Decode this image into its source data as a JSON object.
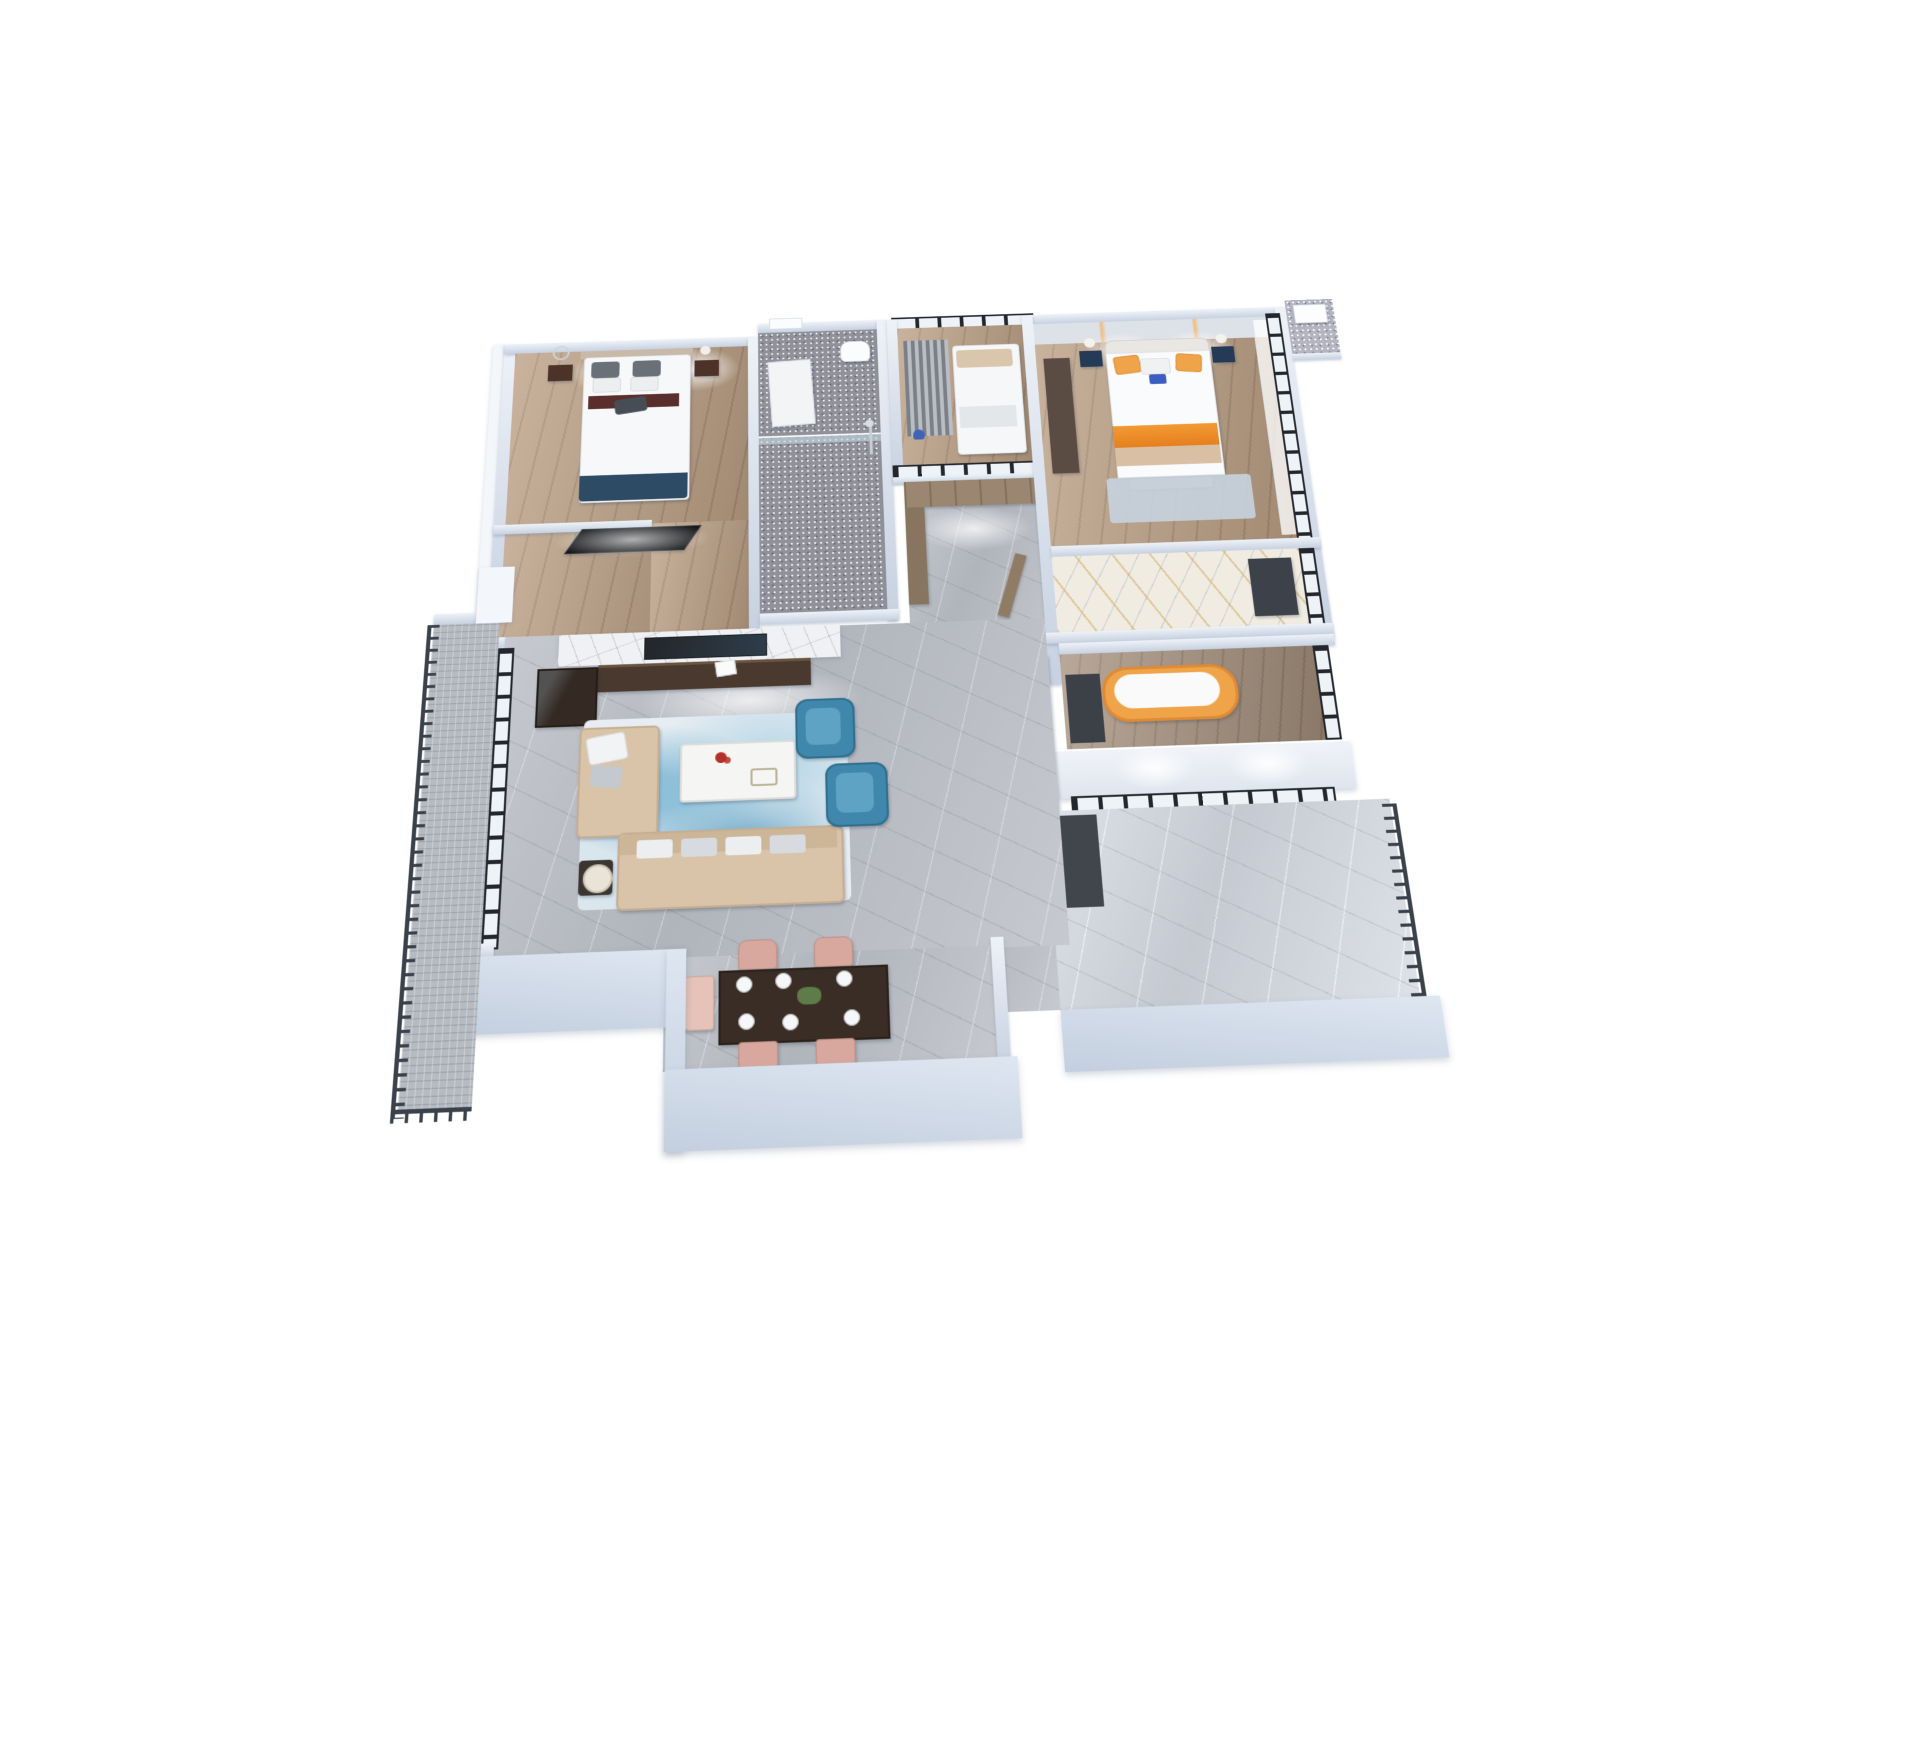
{
  "scene": {
    "type": "3d-floorplan-cutaway-render",
    "view": "overhead dollhouse perspective of a three-bedroom apartment on a white background",
    "rooms": [
      {
        "id": "second-bedroom",
        "area": "top-left",
        "floor": "wood",
        "contents": [
          "double-bed",
          "gray-pillows",
          "dark-red-runner",
          "nightstand-left",
          "nightstand-right",
          "ring-sculpture-lamp",
          "ball-lamp",
          "wall-mounted-tv",
          "ceiling-downlights"
        ]
      },
      {
        "id": "main-bathroom",
        "area": "top-center",
        "floor": "dark-glitter-tile",
        "contents": [
          "toilet",
          "shower-set",
          "glass-partition",
          "white-bath-mat",
          "white-door"
        ]
      },
      {
        "id": "glass-study",
        "area": "center-top",
        "floor": "wood",
        "contents": [
          "daybed-white-bedding",
          "patterned-curtain",
          "blue-figurine",
          "black-framed-glass-walls"
        ]
      },
      {
        "id": "master-bedroom",
        "area": "top-right",
        "floor": "wood",
        "contents": [
          "bed-white-duvet",
          "orange-accent-pillows",
          "orange-runner",
          "lit-headboard-panels",
          "nightstand-lamps",
          "dark-wardrobe",
          "blue-rug",
          "floor-to-ceiling-windows",
          "sheer-curtain",
          "bed-bench"
        ]
      },
      {
        "id": "ensuite-bathroom",
        "area": "right-middle",
        "floor": "white-gold-marble",
        "contents": [
          "dark-vanity",
          "window"
        ]
      },
      {
        "id": "foyer",
        "area": "center",
        "floor": "gray-marble",
        "contents": [
          "wood-wardrobe-cabinets",
          "side-closet",
          "entry-door-ajar"
        ]
      },
      {
        "id": "living-room",
        "area": "center-left",
        "floor": "gray-marble",
        "contents": [
          "marble-tv-wall",
          "recessed-tv",
          "walnut-media-console",
          "display-cabinet",
          "white-sculpture",
          "beige-sectional-sofa",
          "sofa-pillows",
          "white-coffee-table",
          "red-flowers",
          "teal-armchair-1",
          "teal-armchair-2",
          "lamp-side-table",
          "abstract-blue-rug",
          "sliding-glass-doors"
        ]
      },
      {
        "id": "dining-room",
        "area": "bottom-center",
        "floor": "gray-marble",
        "contents": [
          "dark-wood-dining-table",
          "six-place-settings",
          "green-centerpiece",
          "blush-chairs-4",
          "light-blush-armchair"
        ]
      },
      {
        "id": "soak-bathroom",
        "area": "right",
        "floor": "wood",
        "contents": [
          "freestanding-orange-bathtub",
          "dark-entry-mat",
          "black-framed-window",
          "textured-white-wall"
        ]
      },
      {
        "id": "left-balcony",
        "area": "left-edge",
        "floor": "carpet-tile",
        "contents": [
          "dark-metal-railing"
        ]
      },
      {
        "id": "right-balcony",
        "area": "bottom-right",
        "floor": "light-stone",
        "contents": [
          "dark-metal-railing",
          "black-framed-glazing",
          "dark-mat",
          "white-parapet-wall"
        ]
      },
      {
        "id": "utility-platform",
        "area": "top-right-corner",
        "floor": "tile",
        "contents": [
          "white-ac-unit"
        ]
      }
    ]
  },
  "theme": {
    "page-bg": "#ffffff",
    "wall-top": "#eef2f8",
    "wall-face": "#c7d1e1",
    "ext-1": "#dee6f1",
    "ext-2": "#c3cfdf",
    "frame": "#23262c",
    "glass": "#eef3f8",
    "rail": "#3a414b",
    "wood-a": "#bca085",
    "wood-b": "#a5907c",
    "marble-a": "#c6c9cf",
    "marble-b": "#b0b4bb",
    "glitter": "#90919a",
    "carpet": "#b6bac1",
    "slab": "#eff1f4",
    "sofa": "#d9c4aa",
    "teal": "#3f88ac",
    "blush": "#d8a89f",
    "orange": "#f0a449",
    "walnut": "#4a392e"
  }
}
